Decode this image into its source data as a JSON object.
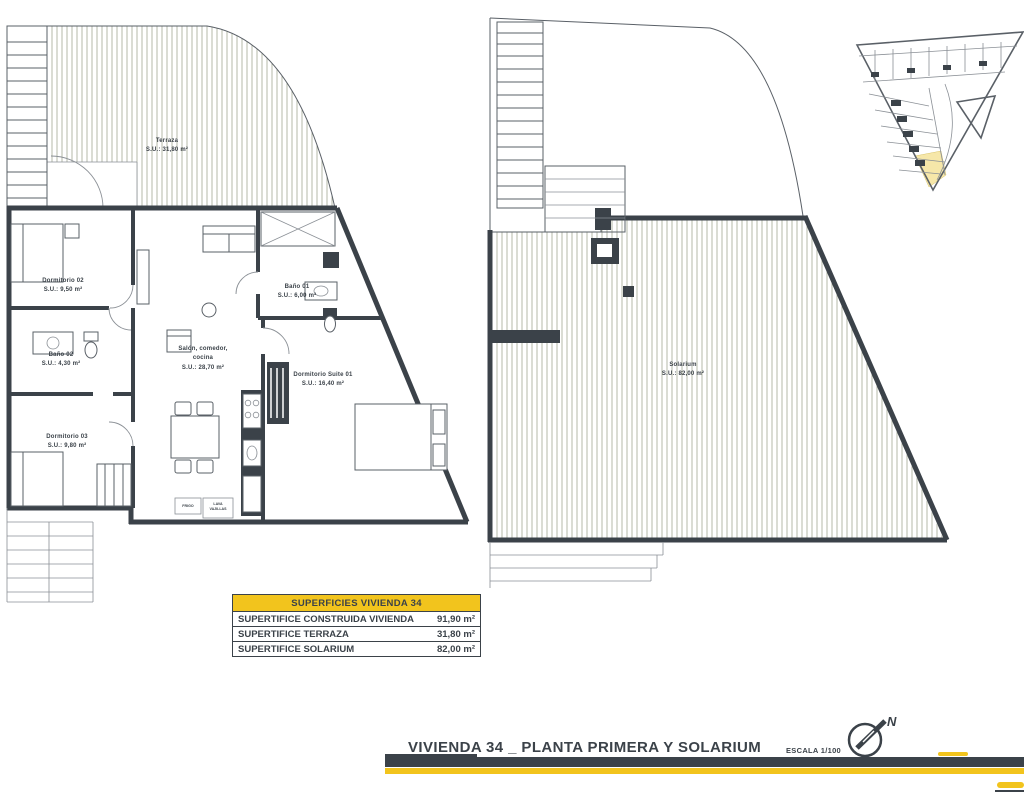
{
  "first_floor": {
    "rooms": [
      {
        "id": "terraza",
        "lines": [
          "Terraza",
          "S.U.: 31,80 m²"
        ]
      },
      {
        "id": "dormitorio-02",
        "lines": [
          "Dormitorio 02",
          "S.U.: 9,50 m²"
        ]
      },
      {
        "id": "bano-01",
        "lines": [
          "Baño 01",
          "S.U.: 6,00 m²"
        ]
      },
      {
        "id": "salon-comedor-cocina",
        "lines": [
          "Salón, comedor,",
          "cocina",
          "S.U.: 28,70 m²"
        ]
      },
      {
        "id": "bano-02",
        "lines": [
          "Baño 02",
          "S.U.: 4,30 m²"
        ]
      },
      {
        "id": "dormitorio-suite-01",
        "lines": [
          "Dormitorio Suite 01",
          "S.U.: 16,40 m²"
        ]
      },
      {
        "id": "dormitorio-03",
        "lines": [
          "Dormitorio 03",
          "S.U.: 9,80 m²"
        ]
      }
    ],
    "appliance_labels": {
      "fridge": "FRIGO",
      "dishwasher_line1": "LAVA",
      "dishwasher_line2": "VAJILLAS"
    }
  },
  "solarium_floor": {
    "rooms": [
      {
        "id": "solarium",
        "lines": [
          "Solarium",
          "S.U.: 82,00 m²"
        ]
      }
    ]
  },
  "surfaces_table": {
    "header": "SUPERFICIES VIVIENDA 34",
    "rows": [
      {
        "label": "SUPERTIFICE CONSTRUIDA VIVIENDA",
        "value": "91,90 m²"
      },
      {
        "label": "SUPERTIFICE TERRAZA",
        "value": "31,80 m²"
      },
      {
        "label": "SUPERTIFICE SOLARIUM",
        "value": "82,00 m²"
      }
    ]
  },
  "title_block": {
    "title": "VIVIENDA 34 _ PLANTA PRIMERA Y SOLARIUM",
    "scale": "ESCALA 1/100",
    "north_label": "N"
  },
  "colors": {
    "ink": "#3b4249",
    "accent_yellow": "#f2c41d",
    "hatch_line": "#adb2a0",
    "site_highlight": "#f6e7a9"
  }
}
